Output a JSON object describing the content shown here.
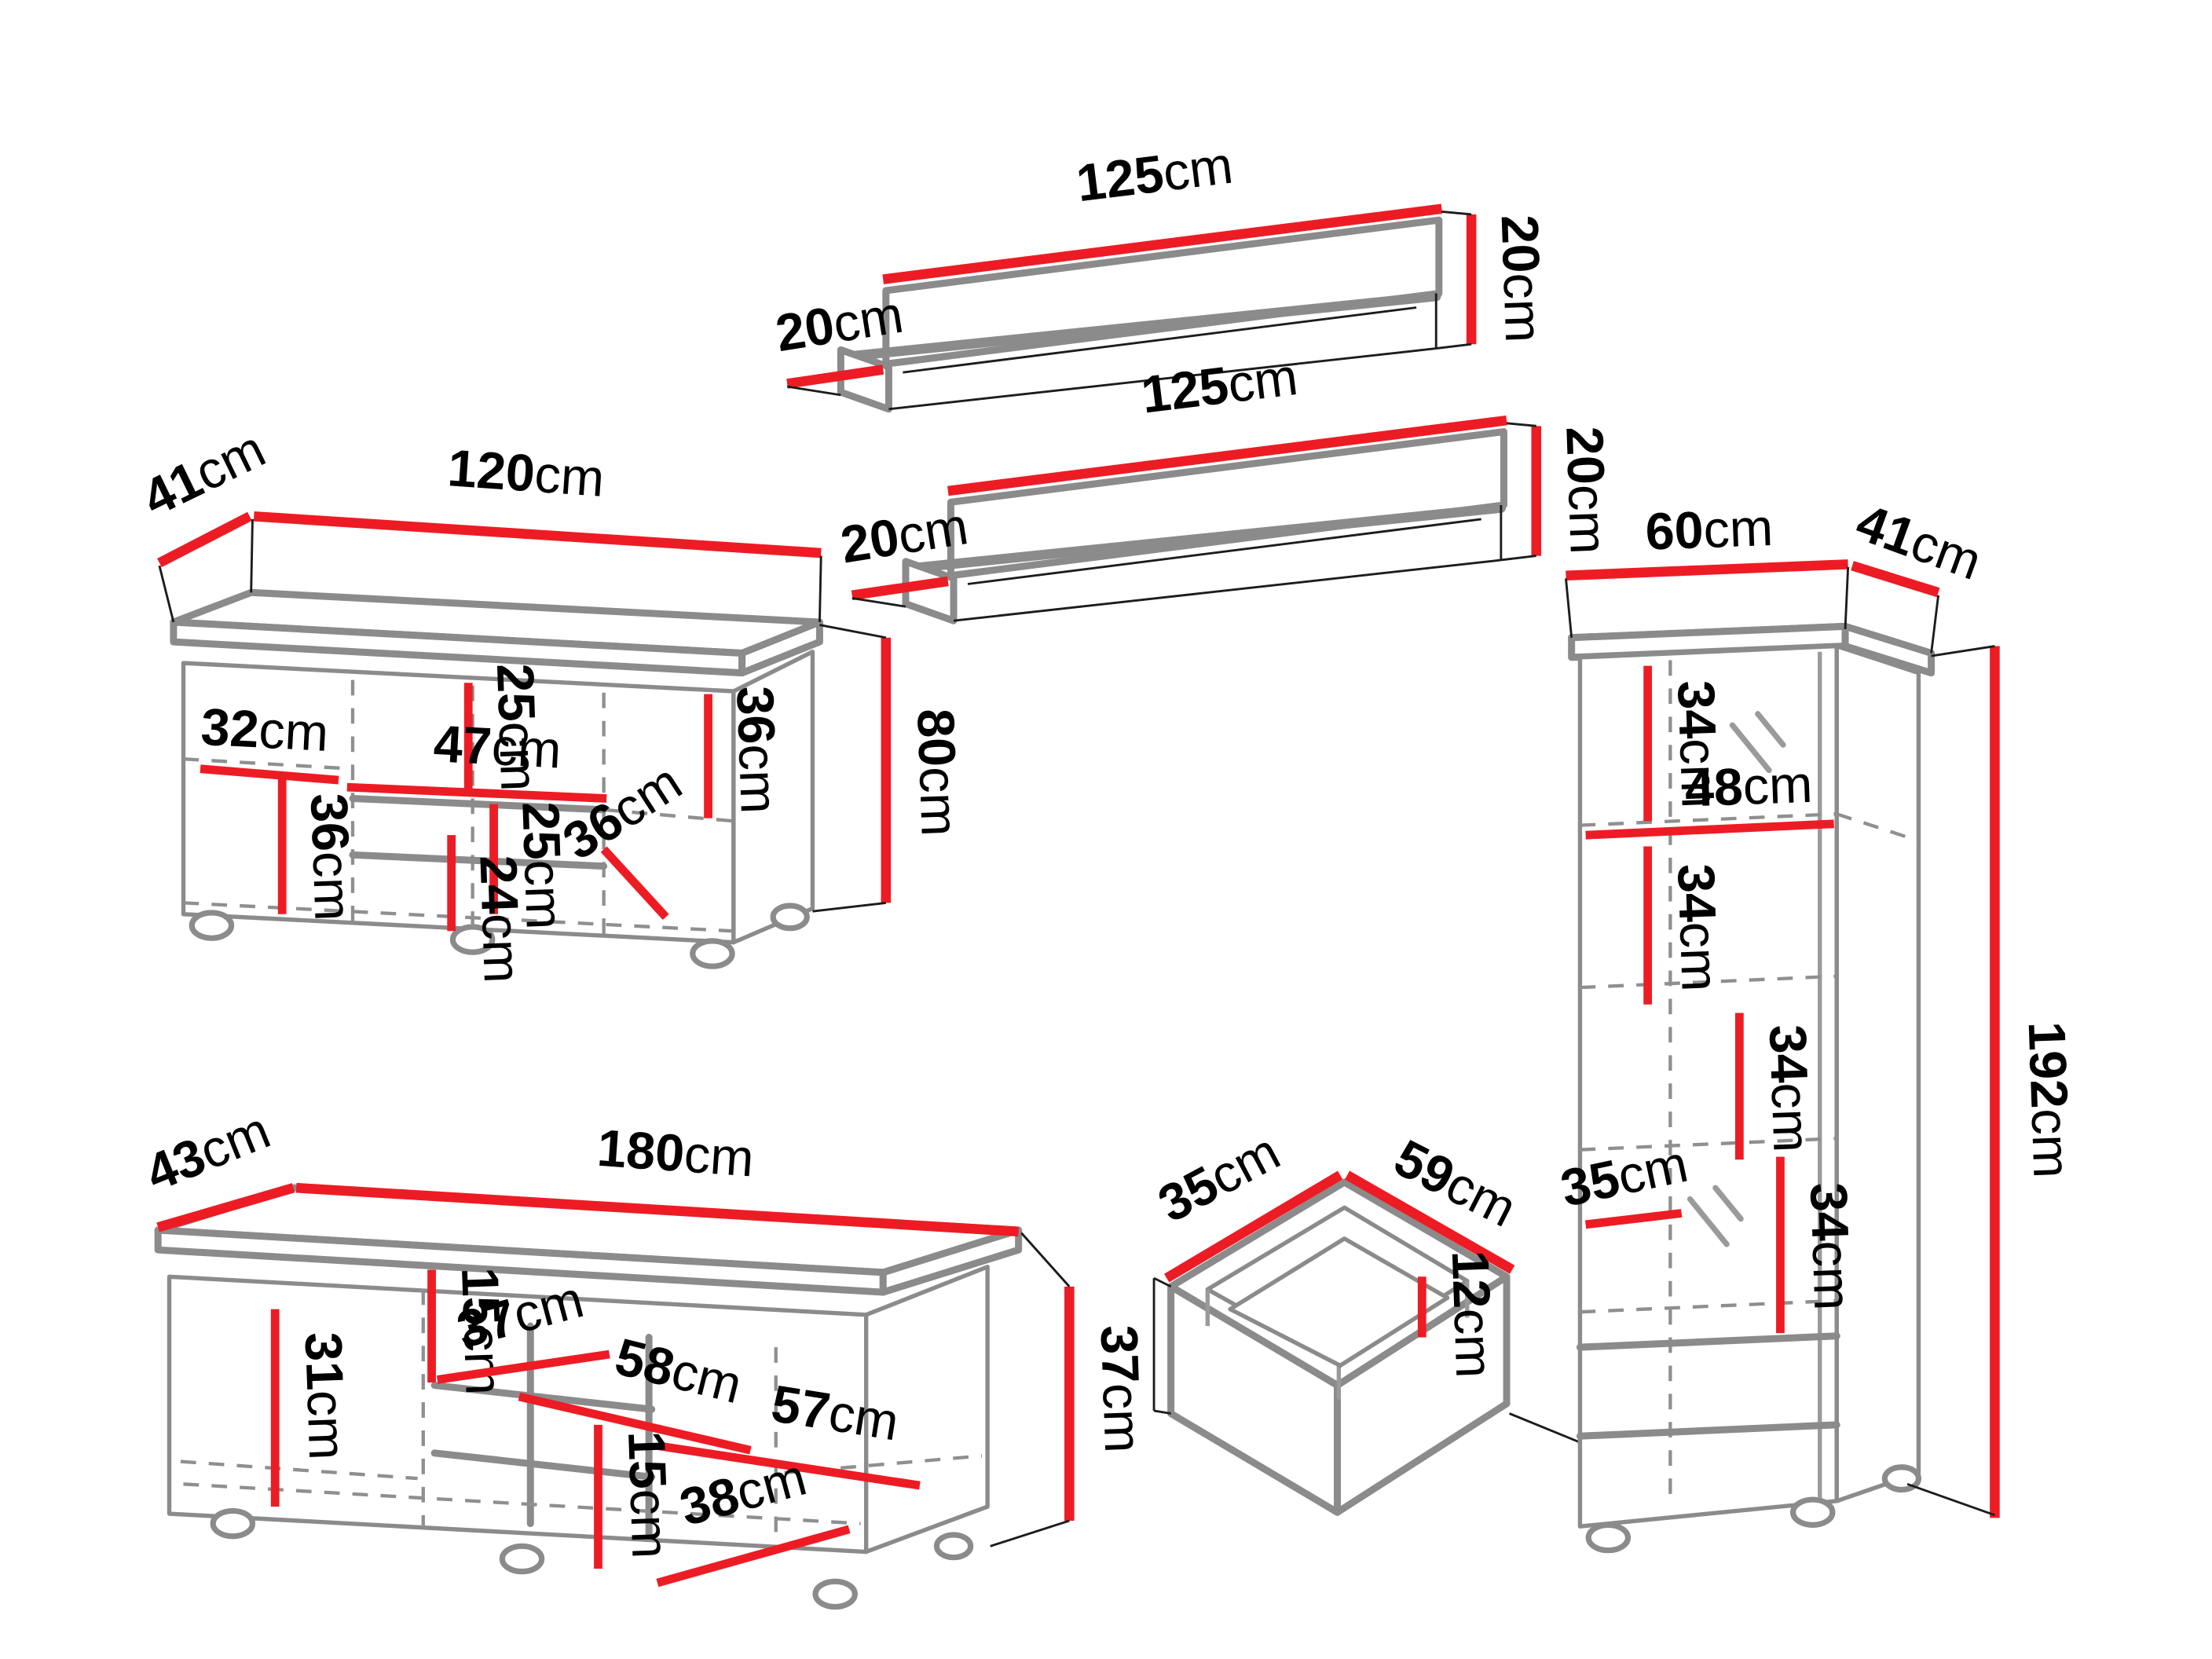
{
  "diagram": {
    "title": "furniture-set-dimensions",
    "unit": "cm",
    "colors": {
      "dimension_red": "#ed1c24",
      "outline_gray": "#8b8b8b",
      "text_black": "#000000",
      "background": "#ffffff"
    },
    "shelf_top": {
      "width": "125",
      "depth": "20",
      "height": "20"
    },
    "shelf_middle": {
      "width": "125",
      "depth": "20",
      "height": "20"
    },
    "sideboard": {
      "depth": "41",
      "width": "120",
      "height": "80",
      "top_section_height": "25",
      "middle_width": "47",
      "right_shelf_height": "36",
      "left_shelf_width": "32",
      "middle_section_height": "25",
      "left_section_height": "36",
      "middle_lower_height": "24",
      "inner_depth": "36"
    },
    "tv_stand": {
      "depth": "43",
      "width": "180",
      "height": "37",
      "left_section_height": "31",
      "upper_section_height": "15",
      "niche_depth": "37",
      "shelf_width": "58",
      "right_section_width": "57",
      "lower_section_height": "15",
      "inner_depth": "38"
    },
    "drawer": {
      "depth": "35",
      "width": "59",
      "height": "12"
    },
    "tall_cabinet": {
      "width": "60",
      "depth": "41",
      "height": "192",
      "section1_height": "34",
      "inner_width": "48",
      "section2_height": "34",
      "section3_height": "34",
      "inner_depth": "35",
      "section4_height": "34"
    }
  }
}
